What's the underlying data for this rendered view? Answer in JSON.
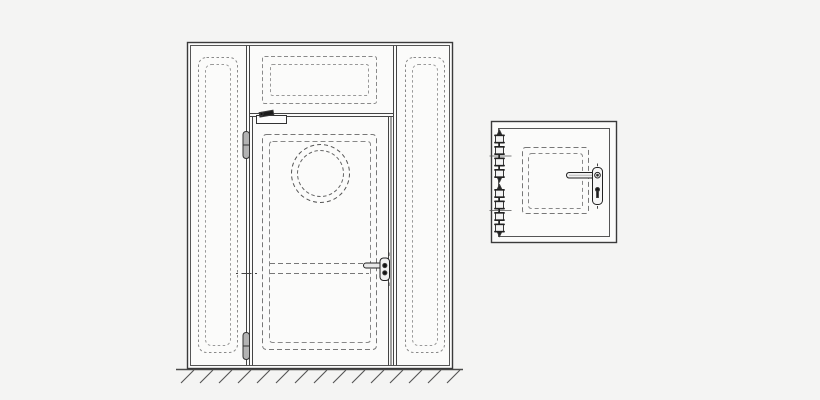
{
  "canvas": {
    "width": 820,
    "height": 400,
    "background": "#f4f4f3"
  },
  "colors": {
    "paper": "#fbfbfa",
    "frame_line": "#3a3a3a",
    "inner_line": "#555555",
    "mullion_line": "#444444",
    "dashed_light": "#8a8a8a",
    "dashed_mid": "#999999",
    "dashed_dark": "#777777",
    "hardware_outline": "#222222",
    "hardware_dark_fill": "#161616",
    "hinge_fill": "#b3b3b3",
    "ground_line": "#4a4a4a",
    "hatch_stroke": "#555555"
  },
  "figures": {
    "door_assembly": {
      "name": "door-assembly-front-view",
      "view": "front elevation",
      "components": [
        "outer-frame",
        "inner-frame",
        "left-side-panel-dashed-outline",
        "right-side-panel-dashed-outline",
        "transom-panel-dashed-outline",
        "transom-rail",
        "door-leaf",
        "door-leaf-panel-dashed-outline",
        "mid-rail-dashed-lines",
        "porthole-window",
        "overhead-door-closer",
        "top-hinge",
        "bottom-hinge",
        "lever-handle-with-rose-and-cylinder",
        "lock-height-centerline-mark",
        "ground-line-with-hatching"
      ]
    },
    "inspection_hatch": {
      "name": "inspection-hatch-front-view",
      "view": "front elevation",
      "components": [
        "outer-frame",
        "inner-frame",
        "hatch-leaf-dashed-outline",
        "piano-hinge-top",
        "piano-hinge-bottom",
        "lever-handle",
        "escutcheon-plate-with-keyhole"
      ]
    }
  }
}
